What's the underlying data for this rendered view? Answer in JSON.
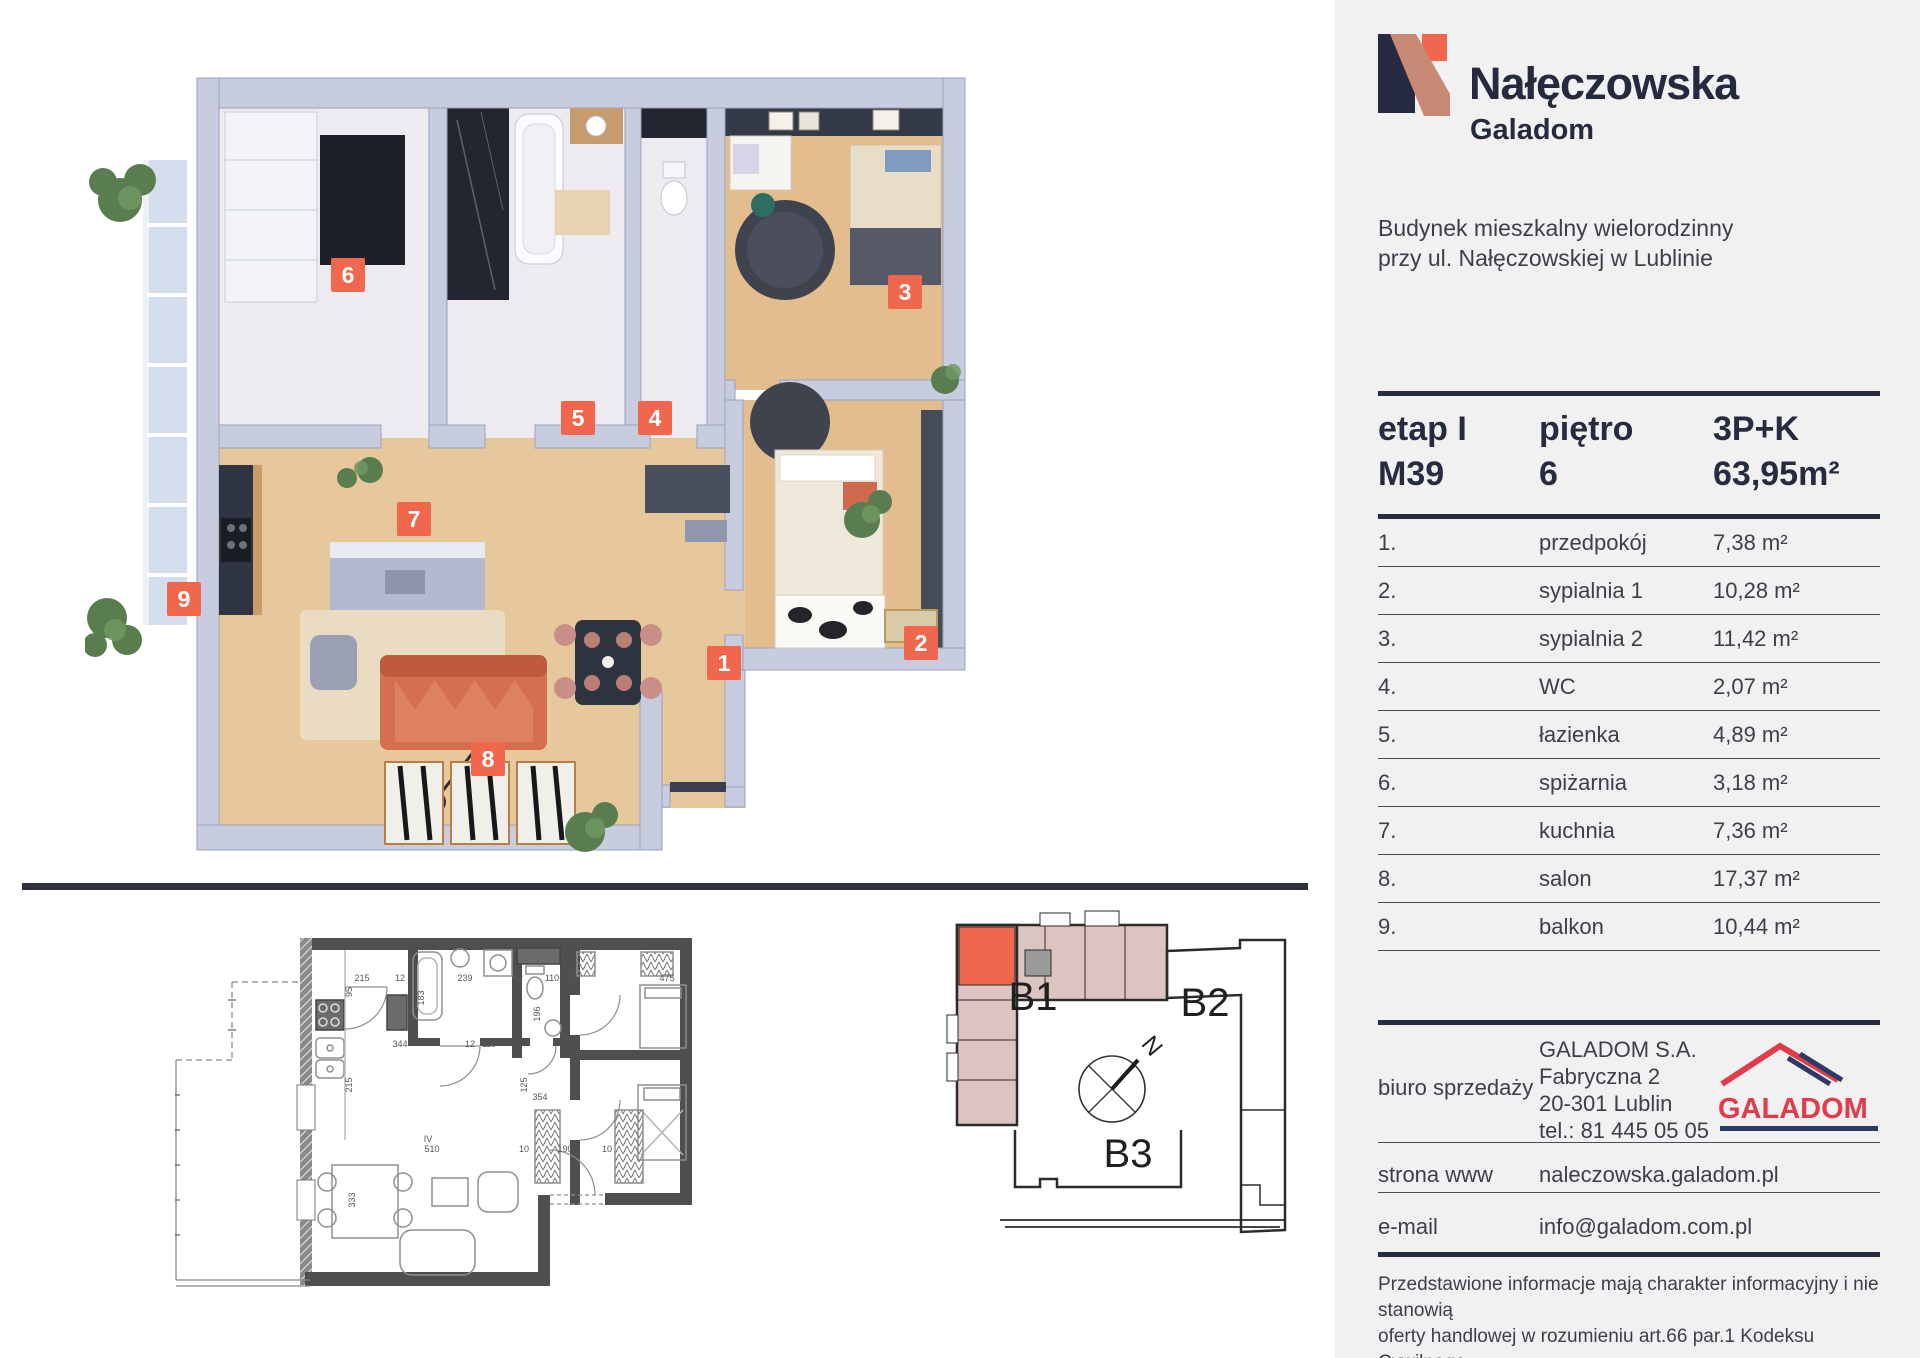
{
  "brand": {
    "project": "Nałęczowska",
    "developer": "Galadom"
  },
  "building_description": {
    "line1": "Budynek mieszkalny wielorodzinny",
    "line2": "przy ul. Nałęczowskiej w Lublinie"
  },
  "unit": {
    "stage_label": "etap I",
    "unit_number": "M39",
    "floor_label": "piętro",
    "floor_value": "6",
    "layout_type": "3P+K",
    "total_area": "63,95m²"
  },
  "rooms": [
    {
      "no": "1.",
      "name": "przedpokój",
      "area": "7,38 m²"
    },
    {
      "no": "2.",
      "name": "sypialnia 1",
      "area": "10,28 m²"
    },
    {
      "no": "3.",
      "name": "sypialnia 2",
      "area": "11,42 m²"
    },
    {
      "no": "4.",
      "name": "WC",
      "area": "2,07 m²"
    },
    {
      "no": "5.",
      "name": "łazienka",
      "area": "4,89 m²"
    },
    {
      "no": "6.",
      "name": "spiżarnia",
      "area": "3,18 m²"
    },
    {
      "no": "7.",
      "name": "kuchnia",
      "area": "7,36 m²"
    },
    {
      "no": "8.",
      "name": "salon",
      "area": "17,37 m²"
    },
    {
      "no": "9.",
      "name": "balkon",
      "area": "10,44 m²"
    }
  ],
  "contact": {
    "office_label": "biuro sprzedaży",
    "company": "GALADOM S.A.",
    "street": "Fabryczna 2",
    "city": "20-301 Lublin",
    "phone": "tel.: 81 445 05 05",
    "logo_text": "GALADOM",
    "website_label": "strona www",
    "website": "naleczowska.galadom.pl",
    "email_label": "e-mail",
    "email": "info@galadom.com.pl"
  },
  "disclaimer": {
    "line1": "Przedstawione informacje mają charakter informacyjny i nie stanowią",
    "line2": "oferty handlowej w rozumieniu art.66 par.1 Kodeksu Cywilnego."
  },
  "floor_plan_3d": {
    "badges": [
      {
        "n": "1",
        "x": 639,
        "y": 613
      },
      {
        "n": "2",
        "x": 836,
        "y": 593
      },
      {
        "n": "3",
        "x": 820,
        "y": 242
      },
      {
        "n": "4",
        "x": 570,
        "y": 368
      },
      {
        "n": "5",
        "x": 493,
        "y": 368
      },
      {
        "n": "6",
        "x": 263,
        "y": 225
      },
      {
        "n": "7",
        "x": 329,
        "y": 469
      },
      {
        "n": "8",
        "x": 403,
        "y": 709
      },
      {
        "n": "9",
        "x": 99,
        "y": 549
      }
    ]
  },
  "site_plan": {
    "labels": [
      {
        "text": "B1",
        "x": 88,
        "y": 115,
        "size": 40,
        "rotate": 0
      },
      {
        "text": "B2",
        "x": 260,
        "y": 121,
        "size": 40,
        "rotate": 0
      },
      {
        "text": "B3",
        "x": 183,
        "y": 272,
        "size": 40,
        "rotate": 0
      },
      {
        "text": "N",
        "x": 201,
        "y": 156,
        "size": 24,
        "rotate": 50
      }
    ]
  },
  "plan_2d": {
    "dimensions": [
      {
        "t": "215",
        "x": 187,
        "y": 51,
        "r": 0
      },
      {
        "t": "12",
        "x": 225,
        "y": 51,
        "r": 0
      },
      {
        "t": "239",
        "x": 290,
        "y": 51,
        "r": 0
      },
      {
        "t": "12",
        "x": 343,
        "y": 51,
        "r": 0
      },
      {
        "t": "110",
        "x": 377,
        "y": 51,
        "r": 0
      },
      {
        "t": "12",
        "x": 397,
        "y": 51,
        "r": 0
      },
      {
        "t": "475",
        "x": 492,
        "y": 51,
        "r": 0
      },
      {
        "t": "95",
        "x": 177,
        "y": 62,
        "r": -90
      },
      {
        "t": "183",
        "x": 249,
        "y": 68,
        "r": -90
      },
      {
        "t": "196",
        "x": 365,
        "y": 84,
        "r": -90
      },
      {
        "t": "344",
        "x": 225,
        "y": 117,
        "r": 0
      },
      {
        "t": "12",
        "x": 295,
        "y": 117,
        "r": 0
      },
      {
        "t": "110",
        "x": 314,
        "y": 117,
        "r": 0
      },
      {
        "t": "215",
        "x": 177,
        "y": 155,
        "r": -90
      },
      {
        "t": "125",
        "x": 352,
        "y": 155,
        "r": -90
      },
      {
        "t": "354",
        "x": 365,
        "y": 170,
        "r": 0
      },
      {
        "t": "510",
        "x": 257,
        "y": 222,
        "r": 0
      },
      {
        "t": "10",
        "x": 349,
        "y": 222,
        "r": 0
      },
      {
        "t": "190",
        "x": 390,
        "y": 222,
        "r": 0
      },
      {
        "t": "10",
        "x": 432,
        "y": 222,
        "r": 0
      },
      {
        "t": "333",
        "x": 180,
        "y": 270,
        "r": -90
      },
      {
        "t": "IV",
        "x": 253,
        "y": 212,
        "r": 0
      }
    ]
  },
  "colors": {
    "accent": "#f0674d",
    "navy": "#272b3f",
    "panel_bg": "#f1f1f2",
    "site_pink": "#dcc5c0",
    "galadom_red": "#e23b4a",
    "galadom_navy": "#2c3a66"
  }
}
